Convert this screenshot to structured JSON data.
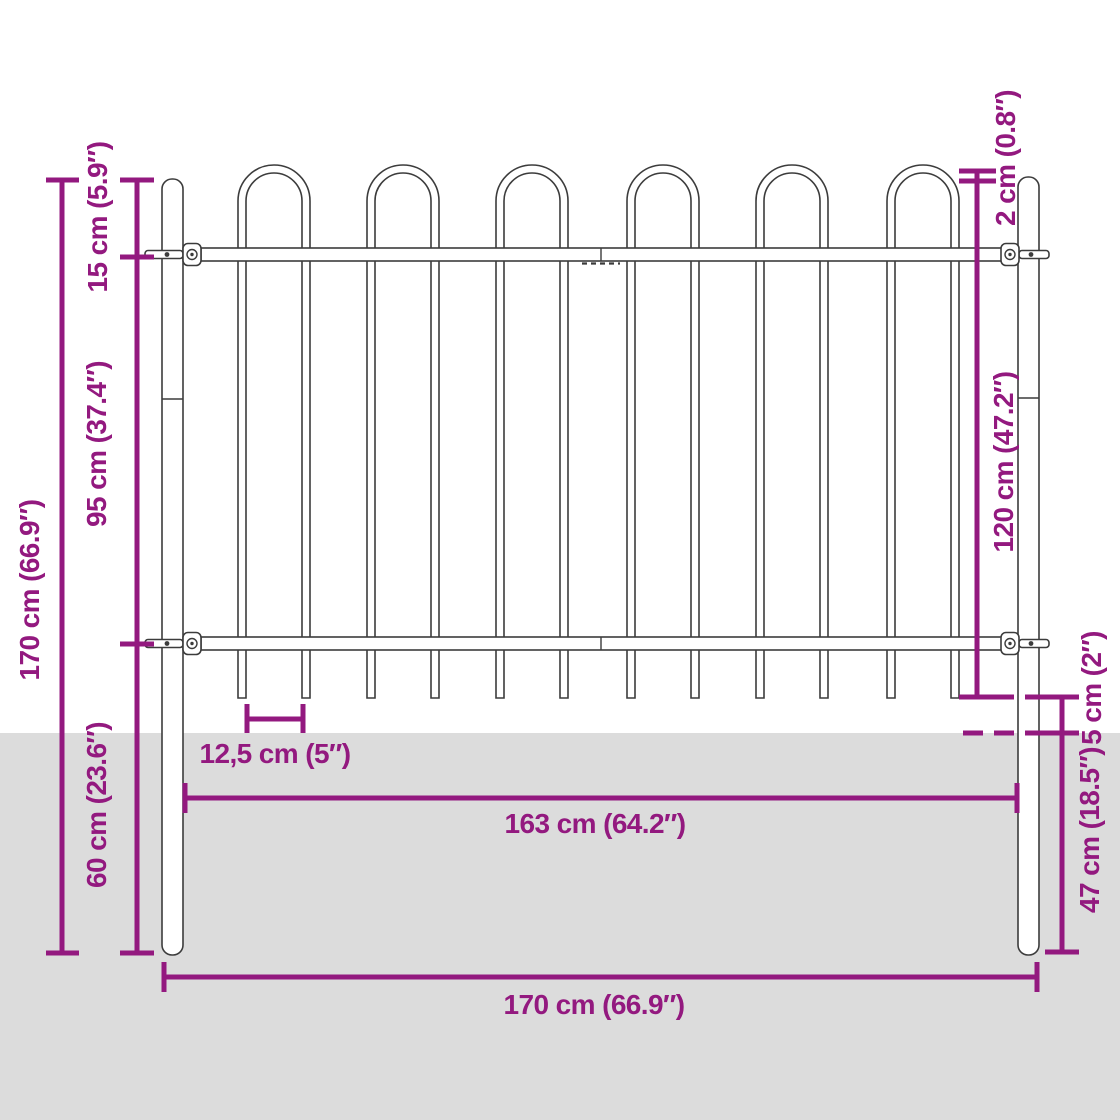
{
  "title": "Garden fence panel with hoop top and posts — dimension diagram",
  "colors": {
    "dimension": "#93197f",
    "ground": "#dcdcdc",
    "outline": "#3c3c3c",
    "background": "#ffffff"
  },
  "labels": {
    "hoop_height": "15 cm (5.9″)",
    "mid_height": "95 cm (37.4″)",
    "total_height": "170 cm (66.9″)",
    "underground_height": "60 cm (23.6″)",
    "hoop_overhang": "2 cm (0.8″)",
    "panel_height": "120 cm (47.2″)",
    "ground_gap": "5 cm (2″)",
    "post_depth": "47 cm (18.5″)",
    "bar_spacing": "12,5 cm (5″)",
    "panel_width": "163 cm (64.2″)",
    "total_width": "170 cm (66.9″)"
  }
}
